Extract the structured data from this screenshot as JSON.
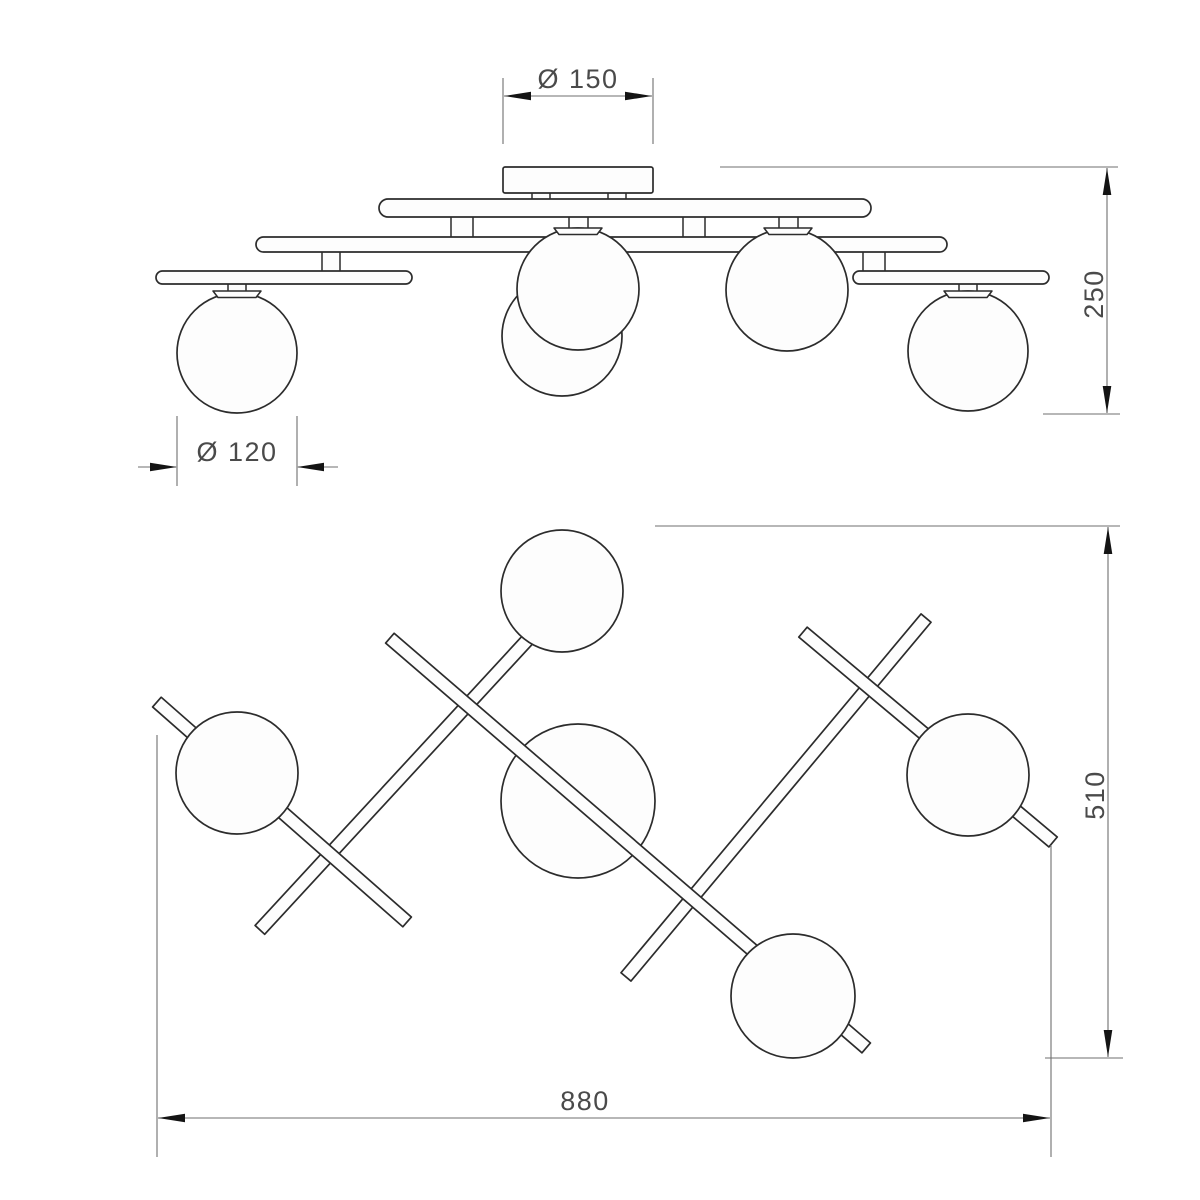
{
  "drawing": {
    "type": "technical-drawing",
    "subject": "5-light ceiling lamp with glass globes, front elevation (top) and plan view (bottom)",
    "views": {
      "top_view_name": "front elevation",
      "bottom_view_name": "plan view"
    },
    "dimensions": {
      "canopy_diameter": "Ø 150",
      "globe_diameter": "Ø 120",
      "height": "250",
      "depth": "510",
      "width": "880"
    },
    "counts": {
      "globes_elevation": 5,
      "globes_plan": 5,
      "rods_plan": 5
    },
    "colors": {
      "outline": "#2c2c2c",
      "dimension_line": "#6f6f6f",
      "arrow": "#141414",
      "label": "#4a4a4a",
      "fill": "#fdfdfd",
      "background": "#ffffff"
    }
  }
}
